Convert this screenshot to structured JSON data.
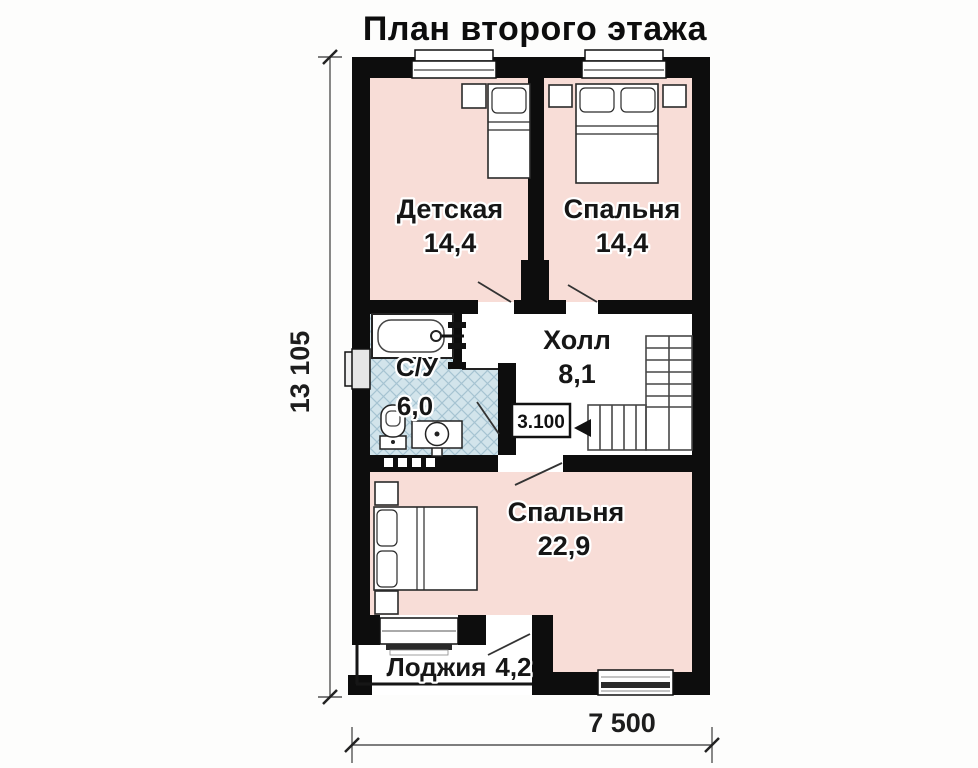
{
  "title": "План второго этажа",
  "rooms": {
    "nursery": {
      "name": "Детская",
      "area": "14,4"
    },
    "bedroom_top": {
      "name": "Спальня",
      "area": "14,4"
    },
    "hall": {
      "name": "Холл",
      "area": "8,1"
    },
    "bathroom": {
      "name": "С/У",
      "area": "6,0"
    },
    "bedroom_main": {
      "name": "Спальня",
      "area": "22,9"
    },
    "loggia": {
      "name": "Лоджия",
      "area": "4,2"
    }
  },
  "elevation_mark": "3.100",
  "dimensions": {
    "vertical": "13 105",
    "horizontal": "7 500"
  },
  "colors": {
    "wall": "#0d0d0d",
    "room_fill": "#f8ddd7",
    "tile_fill": "#d2e4eb",
    "tile_line": "#a6c3d2",
    "background": "#fdfdfc"
  }
}
